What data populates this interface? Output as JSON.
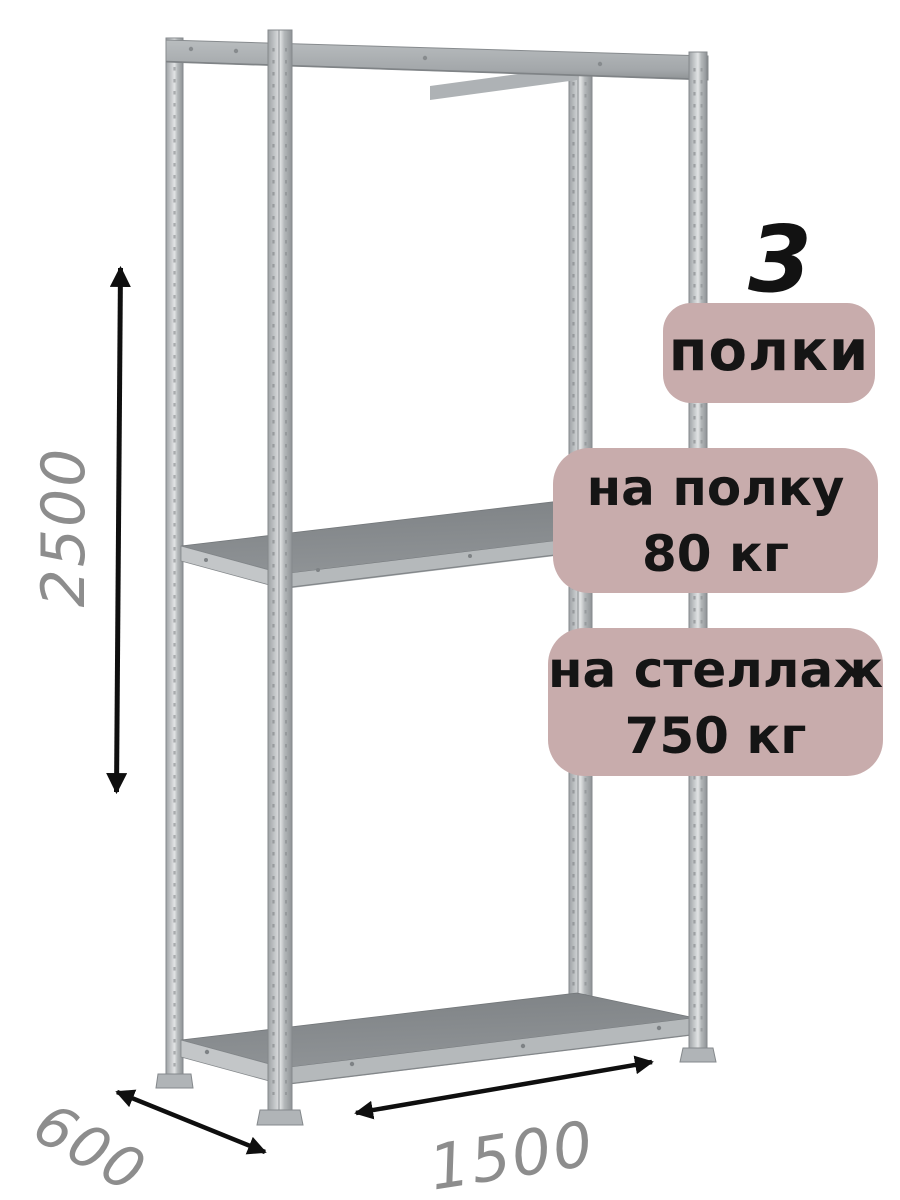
{
  "product_diagram": {
    "shelf_count_number": "3",
    "shelf_count_label": "полки",
    "per_shelf_load": {
      "line1": "на полку",
      "line2": "80 кг"
    },
    "per_rack_load": {
      "line1": "на стеллаж",
      "line2": "750 кг"
    },
    "dimensions": {
      "height_mm": "2500",
      "depth_mm": "600",
      "width_mm": "1500"
    }
  },
  "colors": {
    "badge_bg": "#c8acac",
    "badge_text": "#151515",
    "dimension_text": "#8d8d8d",
    "arrow": "#0f0f0f",
    "metal_light": "#dfe1e2",
    "metal_mid": "#b4b8ba",
    "metal_dark": "#8f9396",
    "background": "#ffffff"
  }
}
